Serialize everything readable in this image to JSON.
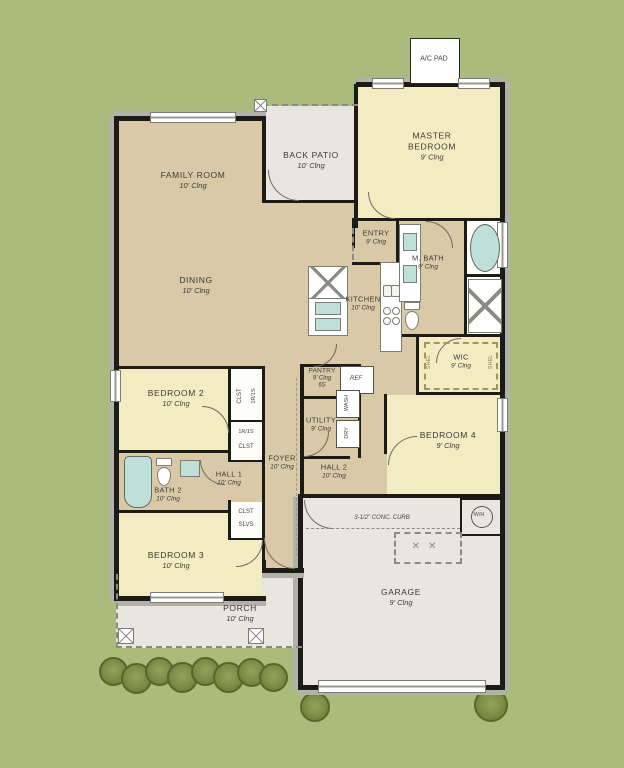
{
  "plan": {
    "colors": {
      "background": "#a9bc7c",
      "interior_tan": "#d9c9a7",
      "bedroom_yellow": "#f3ecc3",
      "slab_gray": "#e9e6df",
      "fixture_teal": "#bfe0d9",
      "wall_black": "#1b1b18"
    },
    "rooms": [
      {
        "id": "family-room",
        "name": "FAMILY ROOM",
        "ceiling": "10' Clng"
      },
      {
        "id": "back-patio",
        "name": "BACK PATIO",
        "ceiling": "10' Clng"
      },
      {
        "id": "master-bedroom",
        "name": "MASTER BEDROOM",
        "ceiling": "9' Clng"
      },
      {
        "id": "entry",
        "name": "ENTRY",
        "ceiling": "9' Clng"
      },
      {
        "id": "master-bath",
        "name": "M. BATH",
        "ceiling": "9' Clng"
      },
      {
        "id": "dining",
        "name": "DINING",
        "ceiling": "10' Clng"
      },
      {
        "id": "kitchen",
        "name": "KITCHEN",
        "ceiling": "10' Clng"
      },
      {
        "id": "wic",
        "name": "WIC",
        "ceiling": "9' Clng"
      },
      {
        "id": "pantry",
        "name": "PANTRY",
        "ceiling": "9' Clng",
        "note": "6S"
      },
      {
        "id": "utility",
        "name": "UTILITY",
        "ceiling": "9' Clng"
      },
      {
        "id": "bedroom-2",
        "name": "BEDROOM 2",
        "ceiling": "10' Clng"
      },
      {
        "id": "foyer",
        "name": "FOYER",
        "ceiling": "10' Clng"
      },
      {
        "id": "hall-1",
        "name": "HALL 1",
        "ceiling": "10' Clng"
      },
      {
        "id": "bath-2",
        "name": "BATH 2",
        "ceiling": "10' Clng"
      },
      {
        "id": "bedroom-3",
        "name": "BEDROOM 3",
        "ceiling": "10' Clng"
      },
      {
        "id": "hall-2",
        "name": "HALL 2",
        "ceiling": "10' Clng"
      },
      {
        "id": "bedroom-4",
        "name": "BEDROOM 4",
        "ceiling": "9' Clng"
      },
      {
        "id": "garage",
        "name": "GARAGE",
        "ceiling": "9' Clng"
      },
      {
        "id": "porch",
        "name": "PORCH",
        "ceiling": "10' Clng"
      }
    ],
    "annotations": {
      "ac_pad": "A/C PAD",
      "conc_curb": "3-1/2\" CONC. CURB",
      "ref": "REF",
      "wash": "WASH",
      "dry": "DRY",
      "water_heater": "W/H",
      "closet": "CLST",
      "shelves": "SLVS",
      "rod_shelf": "1R/1S",
      "shelf": "SHEL"
    }
  }
}
